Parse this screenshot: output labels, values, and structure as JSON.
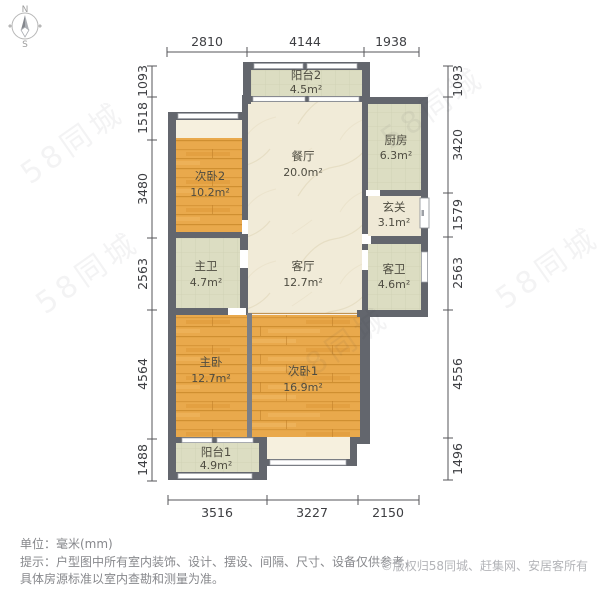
{
  "compass": {
    "north_label": "N",
    "south_label": "S"
  },
  "dimensions": {
    "unit": "mm",
    "top": [
      "2810",
      "4144",
      "1938"
    ],
    "left": [
      "1093",
      "1518",
      "3480",
      "2563",
      "4564",
      "1488"
    ],
    "right": [
      "1093",
      "3420",
      "1579",
      "2563",
      "4556",
      "1496"
    ],
    "bottom": [
      "3516",
      "3227",
      "2150"
    ]
  },
  "rooms": [
    {
      "name": "阳台2",
      "area": "4.5m²"
    },
    {
      "name": "厨房",
      "area": "6.3m²"
    },
    {
      "name": "玄关",
      "area": "3.1m²"
    },
    {
      "name": "客卫",
      "area": "4.6m²"
    },
    {
      "name": "次卧2",
      "area": "10.2m²"
    },
    {
      "name": "餐厅",
      "area": "20.0m²"
    },
    {
      "name": "主卫",
      "area": "4.7m²"
    },
    {
      "name": "客厅",
      "area": "12.7m²"
    },
    {
      "name": "主卧",
      "area": "12.7m²"
    },
    {
      "name": "次卧1",
      "area": "16.9m²"
    },
    {
      "name": "阳台1",
      "area": "4.9m²"
    }
  ],
  "footer": {
    "unit_note": "单位：毫米(mm)",
    "disclaimer_line1": "提示：户型图中所有室内装饰、设计、摆设、间隔、尺寸、设备仅供参考，",
    "disclaimer_line2": "具体房源标准以室内查勘和测量为准。",
    "copyright": "©版权归58同城、赶集网、安居客所有"
  },
  "watermark": {
    "text": "58同城"
  },
  "colors": {
    "wall": "#63666d",
    "wood_floor": "#e9a94c",
    "tile_floor": "#dcddc2",
    "marble_floor": "#f1ebd8",
    "bay_window": "#f6f0de",
    "dimension_text": "#3d3e42",
    "disclaimer_text": "#87888c",
    "copyright_text": "#b3b4b8"
  }
}
